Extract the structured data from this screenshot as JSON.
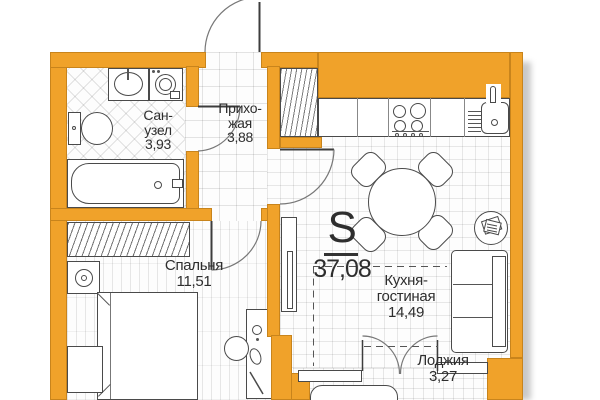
{
  "title": "Apartment floor plan",
  "labels": {
    "total": {
      "symbol": "S",
      "area": "37,08"
    },
    "bathroom": {
      "line1": "Сан-",
      "line2": "узел",
      "area": "3,93"
    },
    "hallway": {
      "line1": "Прихо-",
      "line2": "жая",
      "area": "3,88"
    },
    "bedroom": {
      "line1": "Спальня",
      "area": "11,51"
    },
    "kitchen_living": {
      "line1": "Кухня-",
      "line2": "гостиная",
      "area": "14,49"
    },
    "loggia": {
      "line1": "Лоджия",
      "area": "3,27"
    }
  },
  "colors": {
    "wall": "#F0A22A",
    "wall_edge": "#A87415",
    "grid": "#E0E0E0",
    "outline": "#4A4A4A",
    "text": "#2E2E2E",
    "shadow": "#C9C9C9"
  },
  "icons": [
    "bathtub-icon",
    "toilet-icon",
    "washbasin-icon",
    "washing-machine-icon",
    "vent-shaft-icon",
    "stove-icon",
    "kitchen-sink-icon",
    "drying-rack-icon",
    "dining-table-icon",
    "chair-icon",
    "sofa-icon",
    "side-table-icon",
    "tv-console-icon",
    "bed-icon",
    "nightstand-icon",
    "lamp-icon",
    "wardrobe-icon",
    "vanity-table-icon",
    "stool-icon",
    "door-arc-icon",
    "french-doors-icon",
    "window-sill-icon",
    "bench-icon",
    "zone-dashed-line"
  ]
}
